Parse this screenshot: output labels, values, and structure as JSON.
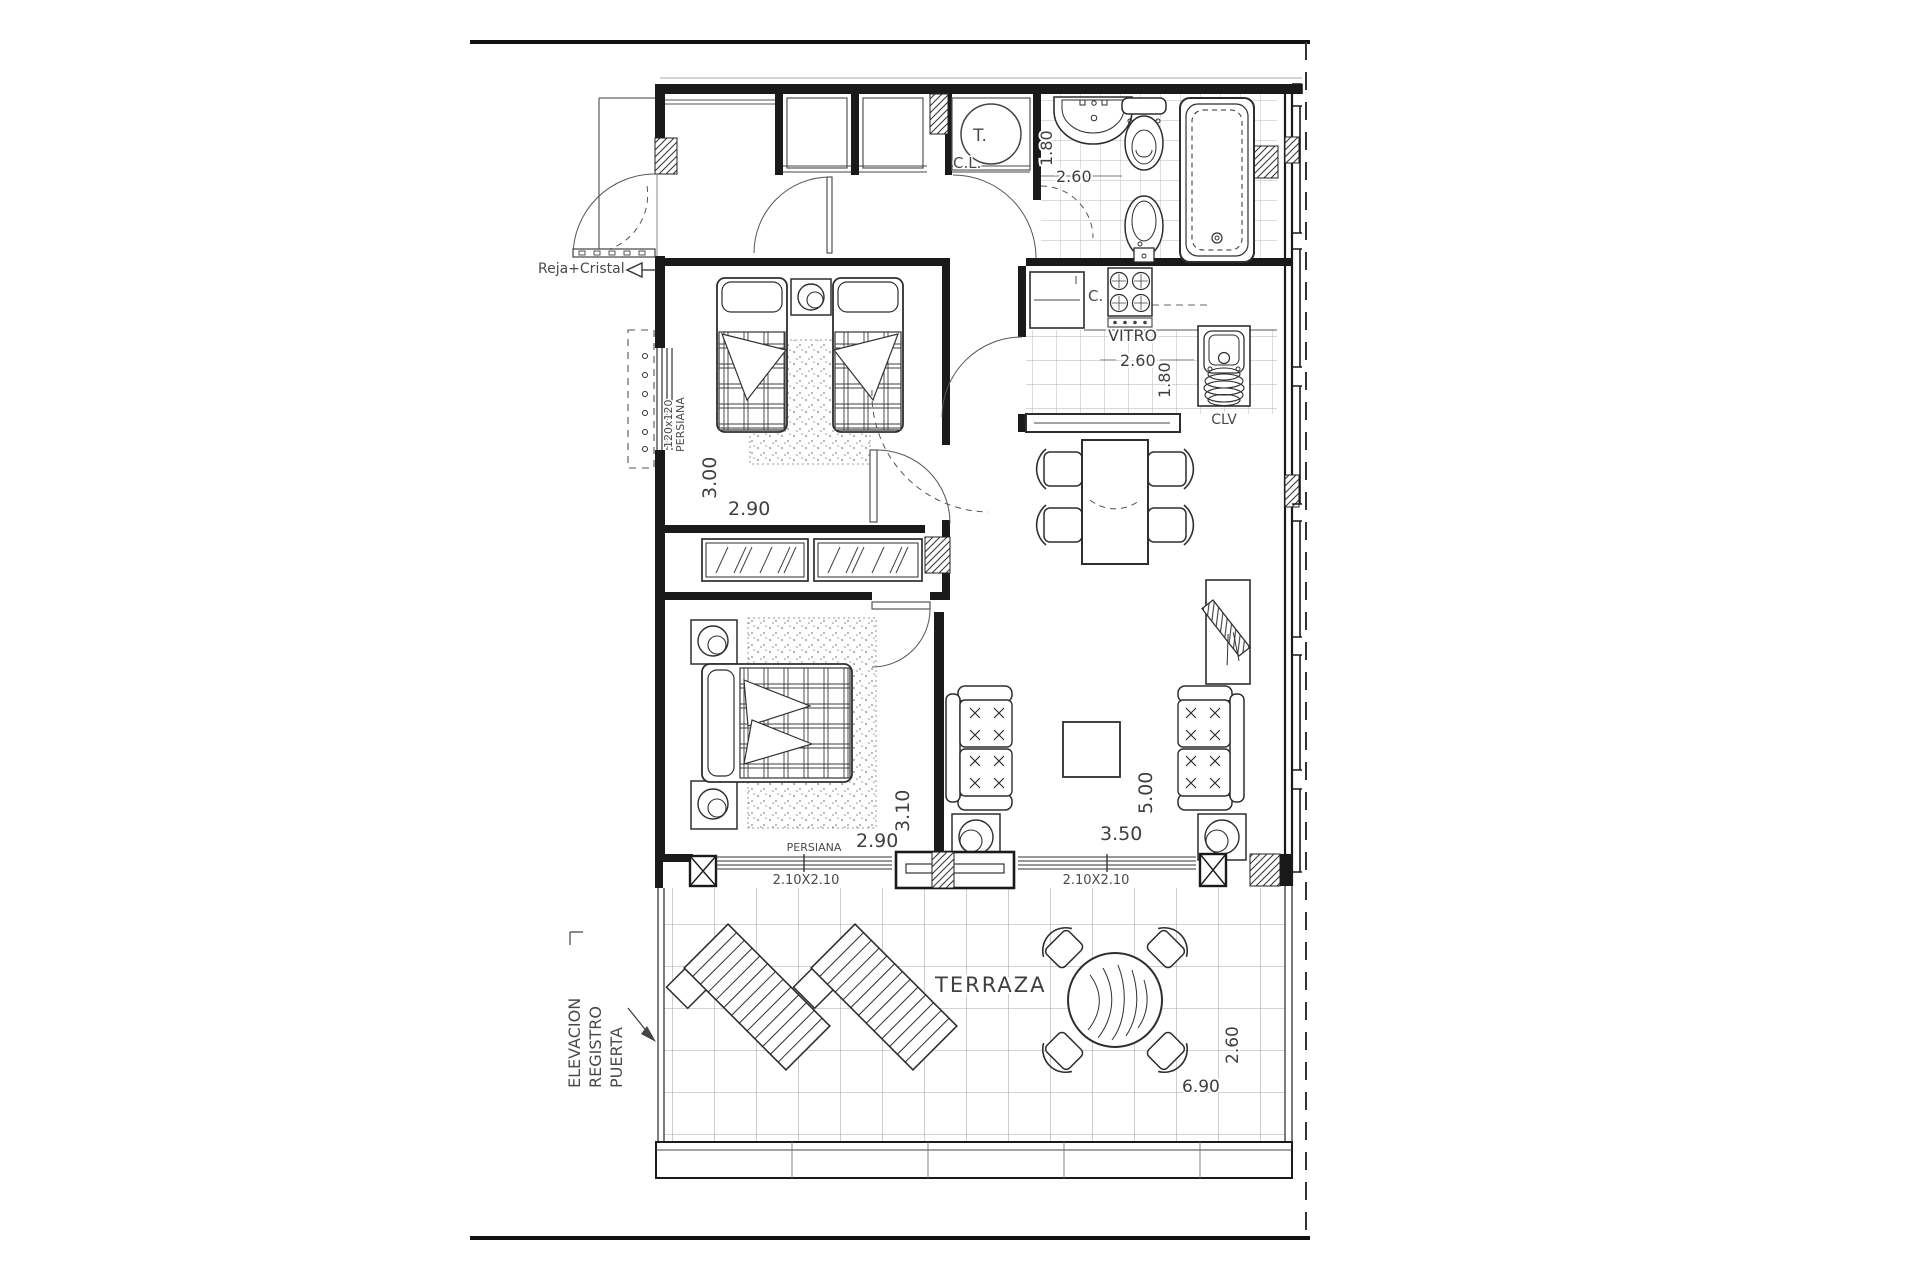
{
  "labels": {
    "reja_cristal": "Reja+Cristal",
    "termo": "T.",
    "closet_cl": "C.L.",
    "bath_width": "1.80",
    "bath_length": "2.60",
    "kitchen_c": "C.",
    "vitro": "VITRO",
    "kitchen_length": "2.60",
    "kitchen_width": "1.80",
    "clv": "CLV",
    "bed2_depth": "3.00",
    "bed2_width": "2.90",
    "shutter_size": "120x120",
    "shutter_word": "PERSIANA",
    "bed1_depth": "3.10",
    "bed1_width": "2.90",
    "persiana_bottom": "PERSIANA",
    "window_left_size": "2.10X2.10",
    "window_right_size": "2.10X2.10",
    "living_depth": "5.00",
    "living_width": "3.50",
    "terraza": "TERRAZA",
    "terrace_width": "6.90",
    "terrace_depth": "2.60",
    "note_line1": "ELEVACION",
    "note_line2": "REGISTRO",
    "note_line3": "PUERTA"
  },
  "colors": {
    "line": "#1a1a1a",
    "dim_text": "#3f3f3f",
    "tile": "#b0b0b0"
  }
}
